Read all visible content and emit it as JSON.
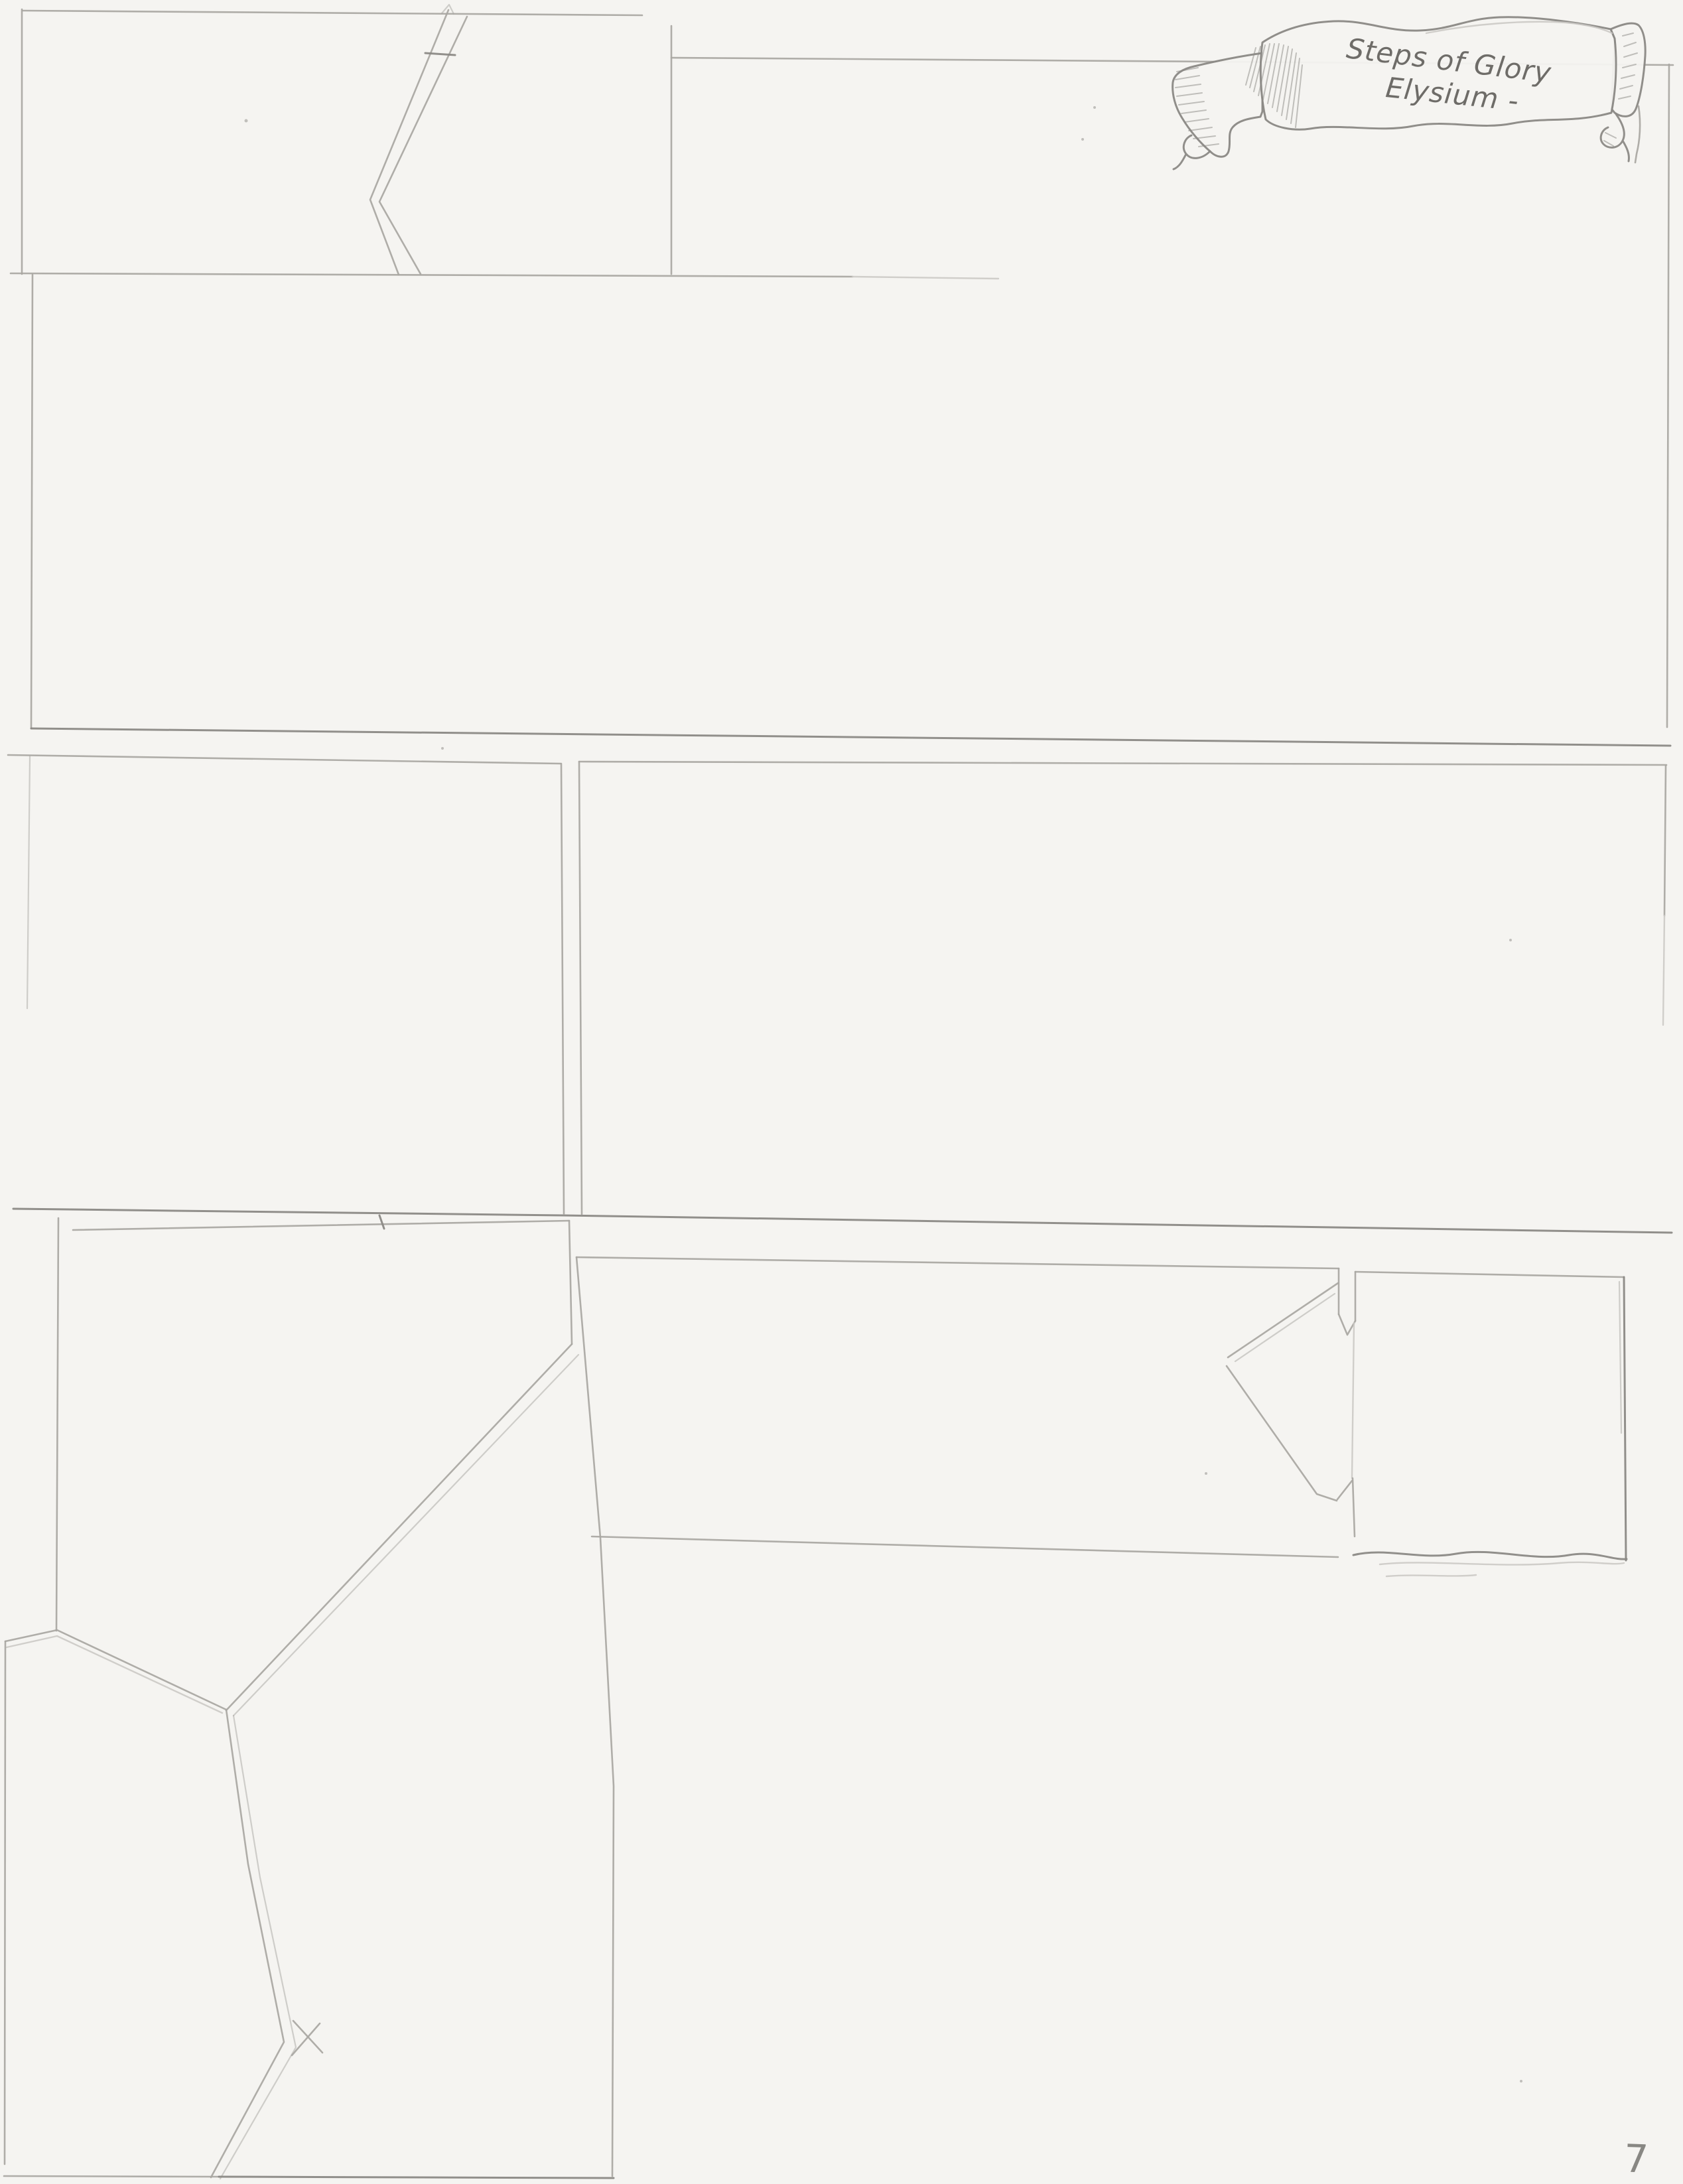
{
  "banner": {
    "line1": "Steps of Glory",
    "line2": "Elysium -"
  },
  "page_number": "7",
  "colors": {
    "paper": "#f5f4f1",
    "pencil": "#a8a6a2",
    "pencil-dark": "#8b8985",
    "pencil-faint": "#c9c7c3",
    "handwriting": "#6e6c68",
    "scan-shadow": "#55534f",
    "scan-edge": "#cfcecb"
  }
}
